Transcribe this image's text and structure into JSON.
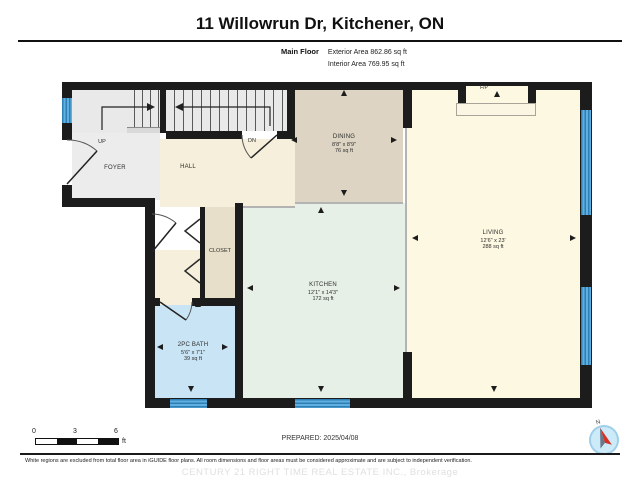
{
  "header": {
    "title": "11 Willowrun Dr, Kitchener, ON",
    "floor_label": "Main Floor",
    "exterior_area": "Exterior Area 862.86 sq ft",
    "interior_area": "Interior Area 769.95 sq ft"
  },
  "rooms": {
    "foyer": {
      "name": "FOYER"
    },
    "hall": {
      "name": "HALL"
    },
    "closet": {
      "name": "CLOSET"
    },
    "dining": {
      "name": "DINING",
      "dims": "8'8\" x 8'9\"",
      "area": "76 sq ft"
    },
    "kitchen": {
      "name": "KITCHEN",
      "dims": "12'1\" x 14'3\"",
      "area": "172 sq ft"
    },
    "living": {
      "name": "LIVING",
      "dims": "12'6\" x 23'",
      "area": "288 sq ft"
    },
    "bath": {
      "name": "2PC BATH",
      "dims": "5'6\" x 7'1\"",
      "area": "39 sq ft"
    }
  },
  "stairs": {
    "up_label": "UP",
    "down_label": "DN"
  },
  "fireplace": {
    "label": "F/P"
  },
  "scale_bar": {
    "t0": "0",
    "t3": "3",
    "t6": "6",
    "unit": "ft"
  },
  "compass": {
    "north_label": "N"
  },
  "footer": {
    "prepared": "PREPARED: 2025/04/08",
    "disclaimer": "White regions are excluded from total floor area in iGUIDE floor plans. All room dimensions and floor areas must be considered approximate and are subject to independent verification.",
    "watermark": "CENTURY 21 RIGHT TIME REAL ESTATE INC., Brokerage"
  },
  "colors": {
    "wall": "#1c1c1c",
    "window_blue": "#4da3d8",
    "foyer_gray": "#ececec",
    "hall_cream": "#f6efdb",
    "dining_tan": "#ddd4c3",
    "closet_tan": "#e7dfc9",
    "kitchen_mint": "#e7f0e6",
    "living_cream": "#fdf8e1",
    "bath_blue": "#c9e4f5"
  }
}
